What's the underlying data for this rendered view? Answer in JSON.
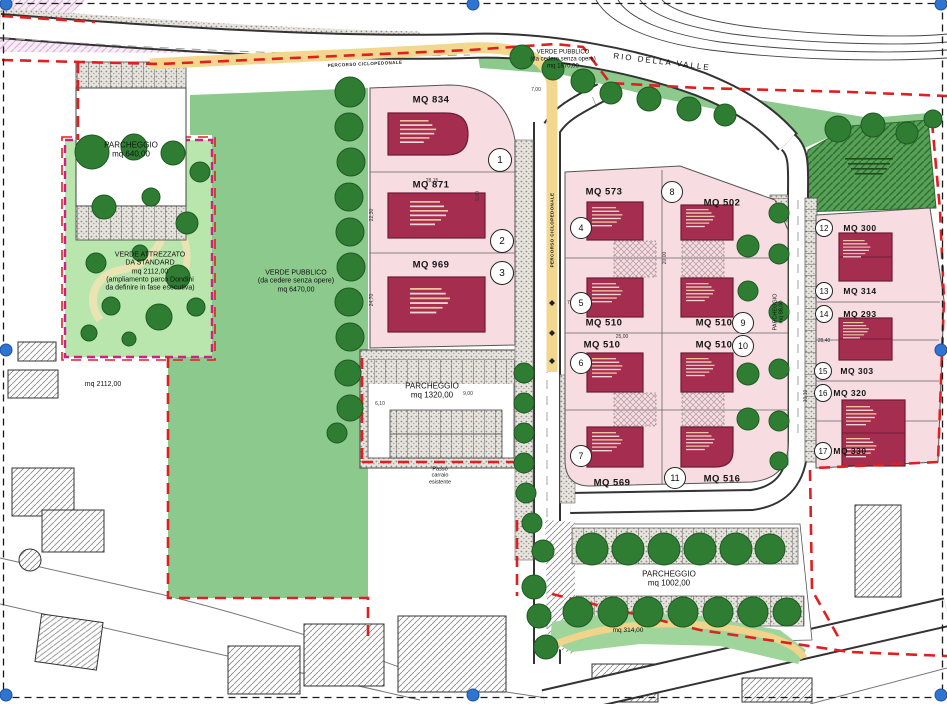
{
  "labels": {
    "pk640": {
      "l1": "PARCHEGGIO",
      "l2": "mq 640,00"
    },
    "pk1320": {
      "l1": "PARCHEGGIO",
      "l2": "mq 1320,00"
    },
    "pk1002": {
      "l1": "PARCHEGGIO",
      "l2": "mq 1002,00"
    },
    "pk88": {
      "l1": "PARCHEGGIO",
      "l2": "mq 88,00"
    },
    "verde_attrezzato": {
      "l1": "VERDE ATTREZZATO",
      "l2": "DA STANDARD",
      "l3": "mq 2112,00",
      "l4": "(ampliamento parco Dondini",
      "l5": "da definire in fase esecutiva)"
    },
    "verde_pubblico_grande": {
      "l1": "VERDE PUBBLICO",
      "l2": "(da cedere senza opere)",
      "l3": "mq 6470,00"
    },
    "verde_pubblico_nord": {
      "l1": "VERDE PUBBLICO",
      "l2": "(da cedere senza opere)",
      "l3": "mq 1870,00"
    },
    "rio": "RIO DELLA VALLE",
    "mq2112": "mq 2112,00",
    "mq314": "mq 314,00",
    "passo": {
      "l1": "Passo",
      "l2": "carraio",
      "l3": "esistente"
    },
    "percorso": "PERCORSO CICLOPEDONALE"
  },
  "lots": [
    {
      "n": "1",
      "mq": "MQ 834"
    },
    {
      "n": "2",
      "mq": "MQ 871"
    },
    {
      "n": "3",
      "mq": "MQ 969"
    },
    {
      "n": "4",
      "mq": "MQ 573"
    },
    {
      "n": "5",
      "mq": "MQ 510"
    },
    {
      "n": "6",
      "mq": "MQ 510"
    },
    {
      "n": "7",
      "mq": "MQ 569"
    },
    {
      "n": "8",
      "mq": "MQ 502"
    },
    {
      "n": "9",
      "mq": "MQ 510"
    },
    {
      "n": "10",
      "mq": "MQ 510"
    },
    {
      "n": "11",
      "mq": "MQ 516"
    },
    {
      "n": "12",
      "mq": "MQ 300"
    },
    {
      "n": "13",
      "mq": "MQ 314"
    },
    {
      "n": "14",
      "mq": "MQ 293"
    },
    {
      "n": "15",
      "mq": "MQ 303"
    },
    {
      "n": "16",
      "mq": "MQ 320"
    },
    {
      "n": "17",
      "mq": "MQ 330"
    }
  ],
  "dims": [
    "28,15",
    "7,00",
    "5,00",
    "20,00",
    "25,00",
    "7,50",
    "6,10",
    "9,00",
    "22,30",
    "24,70",
    "28,40",
    "10,10"
  ],
  "colors": {
    "boundary_red": "#e02020",
    "park_border_magenta": "#cc2288",
    "building_red": "#a52e50",
    "green_public": "#8cc98c",
    "green_park": "#b9e6ad",
    "green_dark_hatch": "#57a057",
    "tree_green": "#2f7d33",
    "path_yellow": "#f2d78f",
    "lot_pink": "#f7dce2",
    "handle_blue": "#2e74d0"
  }
}
